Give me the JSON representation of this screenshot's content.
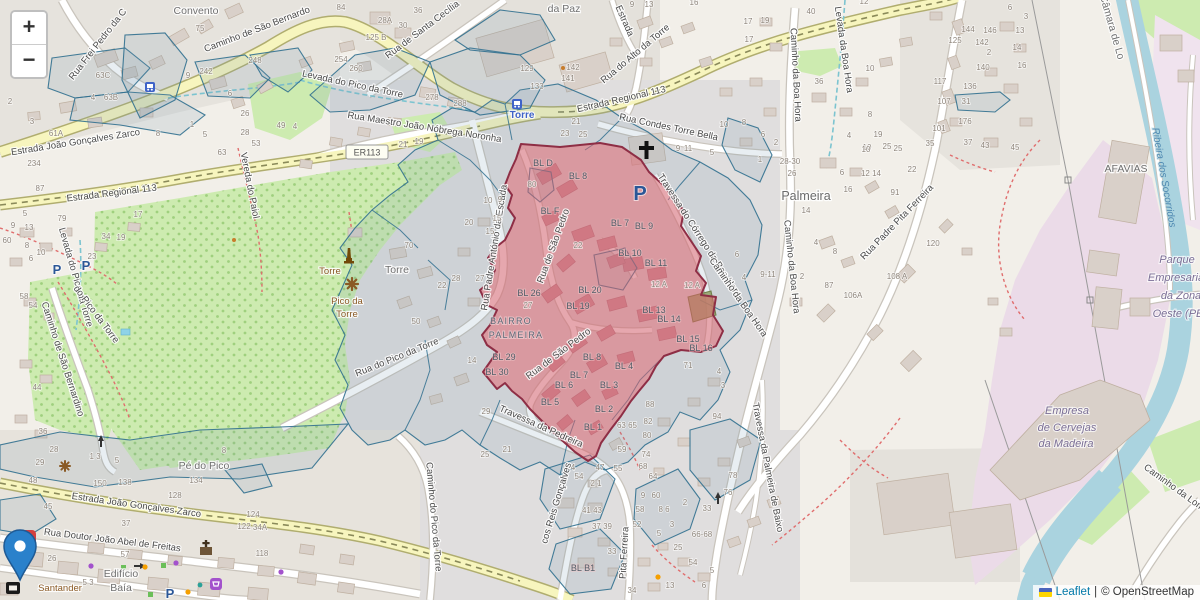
{
  "ui": {
    "zoom_in": "+",
    "zoom_out": "−",
    "attribution": {
      "leaflet": "Leaflet",
      "separator": "|",
      "osm": "© OpenStreetMap"
    }
  },
  "colors": {
    "overlay_blue_stroke": "#31708f",
    "overlay_blue_fill": "#7193ad",
    "highlight_red_stroke": "#8e2e45",
    "highlight_red_fill": "#e4606a",
    "marker_blue": "#2A81CB",
    "leaflet_link": "#0078A8",
    "water": "#aad3df",
    "road_yellow": "#f7f5be",
    "green": "#cdebb0",
    "industrial_pink": "#ebdbe8"
  },
  "map": {
    "shield": {
      "text": "ER113",
      "x": 367,
      "y": 152
    },
    "street_labels": [
      [
        "Rua Frei Pedro da C",
        100,
        46,
        -52
      ],
      [
        "Caminho de São Bernardo",
        258,
        32,
        -21
      ],
      [
        "Rua de Santa Cecília",
        424,
        32,
        -37
      ],
      [
        "Estrada",
        622,
        22,
        66
      ],
      [
        "Rua do Alto da Torre",
        637,
        56,
        -40
      ],
      [
        "Estrada Regional 113",
        622,
        102,
        -13
      ],
      [
        "Rua Condes Torre Bella",
        668,
        130,
        12
      ],
      [
        "Caminho da Boa Hora",
        793,
        75,
        87
      ],
      [
        "Levada da Boa Hora",
        841,
        50,
        82
      ],
      [
        "Estrada Regional 113",
        112,
        196,
        -7
      ],
      [
        "Rua Maestro João Nóbrega Noronha",
        424,
        130,
        9
      ],
      [
        "Levada do Pico da Torre",
        352,
        87,
        12
      ],
      [
        "Estrada João Gonçalves Zarco",
        76,
        145,
        -9
      ],
      [
        "Vereda do Paiol",
        247,
        186,
        79
      ],
      [
        "Levada do Pico da Torre",
        73,
        278,
        74
      ],
      [
        "Caminho de São Bernardino",
        60,
        360,
        72
      ],
      [
        "do Pico da Torre",
        94,
        316,
        53
      ],
      [
        "Rua do Pico da Torre",
        398,
        360,
        -22
      ],
      [
        "Rua Padre António da Escada",
        497,
        248,
        -81
      ],
      [
        "Rua de São Pedro",
        556,
        247,
        -70
      ],
      [
        "Rua de São Pedro",
        560,
        356,
        -37
      ],
      [
        "Travessa do Córrego da Boa Hora",
        697,
        237,
        57
      ],
      [
        "Caminho da Boa Hora",
        736,
        299,
        55
      ],
      [
        "Caminho da Boa Hora",
        789,
        267,
        84
      ],
      [
        "Rua Padre Pita Ferreira",
        899,
        224,
        -46
      ],
      [
        "Travessa da Pedreira",
        540,
        429,
        24
      ],
      [
        "Caminho do Pico da Torre",
        431,
        517,
        85
      ],
      [
        "cos Reis Gonçalves",
        559,
        504,
        -73
      ],
      [
        "Pita Ferreira",
        627,
        553,
        -87
      ],
      [
        "Travessa da Palmeira de Baixo",
        765,
        468,
        79
      ],
      [
        "Estrada João Gonçalves Zarco",
        136,
        508,
        8
      ],
      [
        "Rua Doutor João Abel de Freitas",
        112,
        543,
        7
      ],
      [
        "Caminho da Lombada",
        1181,
        496,
        36
      ]
    ],
    "place_labels": [
      [
        "Convento",
        196,
        14
      ],
      [
        "da Paz",
        564,
        12
      ],
      [
        "Palmeira",
        806,
        200,
        0,
        "lbl-pl"
      ],
      [
        "Pé do Pico",
        204,
        469
      ],
      [
        "Edifício",
        121,
        577
      ],
      [
        "Baía",
        121,
        591
      ],
      [
        "AFAVIAS",
        1126,
        172
      ],
      [
        "Câmara de Lo",
        1109,
        28,
        74
      ],
      [
        "Torre",
        397,
        273
      ],
      [
        "BAIRRO",
        511,
        324,
        0,
        "pl-xs"
      ],
      [
        "PALMEIRA",
        516,
        338,
        0,
        "pl-xs"
      ]
    ],
    "poi_labels": [
      [
        "Torre",
        330,
        274
      ],
      [
        "Pico da",
        347,
        304
      ],
      [
        "Torre",
        347,
        317
      ],
      [
        "Santander",
        60,
        591
      ]
    ],
    "transit_labels": [
      [
        "Torre",
        522,
        118
      ]
    ],
    "water_labels": [
      [
        "Ribeira dos Socorridos",
        1161,
        178,
        80
      ]
    ],
    "landuse_labels": [
      [
        "Parque",
        1177,
        263
      ],
      [
        "Empresaria",
        1176,
        281
      ],
      [
        "da Zona",
        1181,
        299
      ],
      [
        "Oeste (PE",
        1178,
        317
      ],
      [
        "Empresa",
        1067,
        414
      ],
      [
        "de Cervejas",
        1067,
        431
      ],
      [
        "da Madeira",
        1066,
        447
      ]
    ],
    "parking_labels": [
      [
        "P",
        640,
        200,
        0,
        "lbl-pbig"
      ],
      [
        "P",
        57,
        274
      ],
      [
        "P",
        86,
        270
      ],
      [
        "P",
        170,
        598
      ]
    ],
    "block_labels": [
      [
        "BL D",
        543,
        166
      ],
      [
        "BL 8",
        578,
        179
      ],
      [
        "BL F",
        550,
        214
      ],
      [
        "BL 7",
        620,
        226
      ],
      [
        "BL 9",
        644,
        229
      ],
      [
        "BL 10",
        630,
        256
      ],
      [
        "BL 11",
        656,
        266
      ],
      [
        "BL 20",
        590,
        293
      ],
      [
        "BL 19",
        578,
        309
      ],
      [
        "BL 26",
        529,
        296
      ],
      [
        "BL 13",
        654,
        313
      ],
      [
        "BL 14",
        669,
        322
      ],
      [
        "BL 15",
        688,
        342
      ],
      [
        "BL 16",
        701,
        351
      ],
      [
        "BL 8",
        592,
        360
      ],
      [
        "BL 4",
        624,
        369
      ],
      [
        "BL 7",
        579,
        378
      ],
      [
        "BL 6",
        564,
        388
      ],
      [
        "BL 3",
        609,
        388
      ],
      [
        "BL 5",
        550,
        405
      ],
      [
        "BL 2",
        604,
        412
      ],
      [
        "BL 1",
        593,
        430
      ],
      [
        "BL 29",
        504,
        360
      ],
      [
        "BL 30",
        497,
        375
      ],
      [
        "BL B1",
        583,
        571
      ]
    ],
    "house_numbers": [
      [
        "75",
        200,
        31
      ],
      [
        "63C",
        103,
        78
      ],
      [
        "4",
        93,
        100
      ],
      [
        "63B",
        111,
        100
      ],
      [
        "2",
        10,
        104
      ],
      [
        "3",
        32,
        124
      ],
      [
        "61A",
        56,
        136
      ],
      [
        "8",
        158,
        136
      ],
      [
        "1",
        192,
        127
      ],
      [
        "5",
        205,
        137
      ],
      [
        "248",
        255,
        63
      ],
      [
        "242",
        206,
        74
      ],
      [
        "9",
        188,
        78
      ],
      [
        "6",
        230,
        96
      ],
      [
        "26",
        245,
        116
      ],
      [
        "28",
        245,
        135
      ],
      [
        "49",
        281,
        128
      ],
      [
        "4",
        295,
        129
      ],
      [
        "53",
        256,
        146
      ],
      [
        "84",
        341,
        10
      ],
      [
        "28A",
        385,
        23
      ],
      [
        "30",
        403,
        28
      ],
      [
        "36",
        418,
        13
      ],
      [
        "125 B",
        376,
        40
      ],
      [
        "254",
        341,
        62
      ],
      [
        "260",
        356,
        71
      ],
      [
        "278",
        432,
        100
      ],
      [
        "288",
        460,
        106
      ],
      [
        "129",
        527,
        71
      ],
      [
        "142",
        573,
        70
      ],
      [
        "141",
        568,
        81
      ],
      [
        "133",
        537,
        89
      ],
      [
        "21",
        403,
        147
      ],
      [
        "19",
        419,
        144
      ],
      [
        "21",
        576,
        124
      ],
      [
        "23",
        565,
        136
      ],
      [
        "25",
        583,
        137
      ],
      [
        "9",
        632,
        7
      ],
      [
        "13",
        649,
        7
      ],
      [
        "16",
        694,
        5
      ],
      [
        "17",
        748,
        24
      ],
      [
        "19",
        765,
        23
      ],
      [
        "17",
        749,
        42
      ],
      [
        "40",
        811,
        14
      ],
      [
        "12",
        864,
        4
      ],
      [
        "36",
        819,
        84
      ],
      [
        "10",
        870,
        71
      ],
      [
        "8",
        870,
        117
      ],
      [
        "6",
        763,
        137
      ],
      [
        "2",
        776,
        145
      ],
      [
        "10",
        724,
        127
      ],
      [
        "8",
        744,
        125
      ],
      [
        "4",
        849,
        138
      ],
      [
        "19",
        878,
        137
      ],
      [
        "10",
        867,
        150
      ],
      [
        "25",
        887,
        149
      ],
      [
        "9",
        678,
        151
      ],
      [
        "11",
        688,
        151
      ],
      [
        "5",
        712,
        155
      ],
      [
        "6",
        1010,
        10
      ],
      [
        "3",
        1026,
        19
      ],
      [
        "13",
        1020,
        33
      ],
      [
        "14",
        1017,
        50
      ],
      [
        "16",
        1022,
        68
      ],
      [
        "144",
        968,
        32
      ],
      [
        "146",
        990,
        33
      ],
      [
        "125",
        955,
        43
      ],
      [
        "142",
        982,
        45
      ],
      [
        "2",
        989,
        55
      ],
      [
        "140",
        983,
        70
      ],
      [
        "136",
        970,
        89
      ],
      [
        "117",
        940,
        84
      ],
      [
        "107",
        944,
        104
      ],
      [
        "31",
        966,
        104
      ],
      [
        "101",
        939,
        131
      ],
      [
        "176",
        965,
        124
      ],
      [
        "35",
        930,
        146
      ],
      [
        "37",
        968,
        145
      ],
      [
        "43",
        985,
        148
      ],
      [
        "45",
        1015,
        150
      ],
      [
        "234",
        34,
        166
      ],
      [
        "87",
        40,
        191
      ],
      [
        "5",
        25,
        216
      ],
      [
        "9",
        13,
        228
      ],
      [
        "13",
        29,
        230
      ],
      [
        "60",
        7,
        243
      ],
      [
        "8",
        27,
        248
      ],
      [
        "10",
        41,
        255
      ],
      [
        "6",
        31,
        261
      ],
      [
        "79",
        62,
        221
      ],
      [
        "34",
        106,
        239
      ],
      [
        "19",
        121,
        240
      ],
      [
        "23",
        92,
        259
      ],
      [
        "17",
        138,
        217
      ],
      [
        "63",
        222,
        155
      ],
      [
        "58",
        24,
        299
      ],
      [
        "54",
        33,
        308
      ],
      [
        "44",
        37,
        390
      ],
      [
        "36",
        43,
        434
      ],
      [
        "28",
        54,
        452
      ],
      [
        "29",
        40,
        465
      ],
      [
        "70",
        409,
        248
      ],
      [
        "28",
        456,
        281
      ],
      [
        "22",
        442,
        288
      ],
      [
        "50",
        416,
        324
      ],
      [
        "14",
        472,
        363
      ],
      [
        "15",
        490,
        234
      ],
      [
        "10",
        488,
        203
      ],
      [
        "9",
        500,
        202
      ],
      [
        "20",
        469,
        225
      ],
      [
        "15",
        497,
        221
      ],
      [
        "27",
        480,
        281
      ],
      [
        "22",
        578,
        248
      ],
      [
        "80",
        532,
        187
      ],
      [
        "6",
        737,
        257
      ],
      [
        "12 A",
        659,
        287
      ],
      [
        "12 A",
        692,
        288
      ],
      [
        "27",
        528,
        308
      ],
      [
        "4",
        744,
        280
      ],
      [
        "71",
        688,
        368
      ],
      [
        "4",
        719,
        374
      ],
      [
        "3",
        723,
        388
      ],
      [
        "94",
        717,
        419
      ],
      [
        "88",
        650,
        407
      ],
      [
        "82",
        648,
        424
      ],
      [
        "80",
        647,
        438
      ],
      [
        "63 65",
        627,
        428
      ],
      [
        "59",
        622,
        452
      ],
      [
        "74",
        646,
        457
      ],
      [
        "68",
        643,
        469
      ],
      [
        "55",
        618,
        471
      ],
      [
        "64",
        653,
        479
      ],
      [
        "54",
        579,
        479
      ],
      [
        "29",
        486,
        414
      ],
      [
        "25",
        485,
        457
      ],
      [
        "21",
        507,
        452
      ],
      [
        "2 1",
        596,
        486
      ],
      [
        "4",
        573,
        470
      ],
      [
        "47",
        600,
        470
      ],
      [
        "41 43",
        592,
        513
      ],
      [
        "37 39",
        602,
        529
      ],
      [
        "9",
        643,
        498
      ],
      [
        "60",
        656,
        498
      ],
      [
        "58",
        640,
        512
      ],
      [
        "8 6",
        664,
        512
      ],
      [
        "2",
        685,
        505
      ],
      [
        "3",
        672,
        527
      ],
      [
        "5",
        659,
        536
      ],
      [
        "52",
        637,
        527
      ],
      [
        "33",
        612,
        554
      ],
      [
        "34",
        632,
        593
      ],
      [
        "66-68",
        702,
        537
      ],
      [
        "33",
        707,
        511
      ],
      [
        "25",
        678,
        550
      ],
      [
        "54",
        693,
        565
      ],
      [
        "5",
        712,
        573
      ],
      [
        "13",
        670,
        588
      ],
      [
        "6",
        704,
        588
      ],
      [
        "78",
        733,
        478
      ],
      [
        "76",
        728,
        495
      ],
      [
        "28-30",
        790,
        164
      ],
      [
        "26",
        792,
        176
      ],
      [
        "6",
        842,
        175
      ],
      [
        "12 14",
        871,
        176
      ],
      [
        "16",
        848,
        192
      ],
      [
        "14",
        806,
        213
      ],
      [
        "10",
        866,
        152
      ],
      [
        "25",
        898,
        151
      ],
      [
        "22",
        912,
        172
      ],
      [
        "91",
        895,
        195
      ],
      [
        "4",
        816,
        245
      ],
      [
        "8",
        835,
        254
      ],
      [
        "9-11",
        768,
        277
      ],
      [
        "2",
        802,
        279
      ],
      [
        "87",
        829,
        288
      ],
      [
        "106A",
        853,
        298
      ],
      [
        "108 A",
        897,
        279
      ],
      [
        "120",
        933,
        246
      ],
      [
        "1",
        760,
        162
      ],
      [
        "150",
        100,
        486
      ],
      [
        "138",
        125,
        485
      ],
      [
        "134",
        196,
        483
      ],
      [
        "128",
        175,
        498
      ],
      [
        "37",
        126,
        526
      ],
      [
        "26",
        52,
        561
      ],
      [
        "57",
        125,
        557
      ],
      [
        "5 3",
        88,
        585
      ],
      [
        "8",
        224,
        453
      ],
      [
        "1 3",
        95,
        459
      ],
      [
        "5",
        117,
        463
      ],
      [
        "124",
        253,
        517
      ],
      [
        "122",
        244,
        529
      ],
      [
        "34A",
        260,
        530
      ],
      [
        "118",
        262,
        556
      ],
      [
        "45",
        48,
        509
      ],
      [
        "48",
        33,
        483
      ]
    ]
  }
}
